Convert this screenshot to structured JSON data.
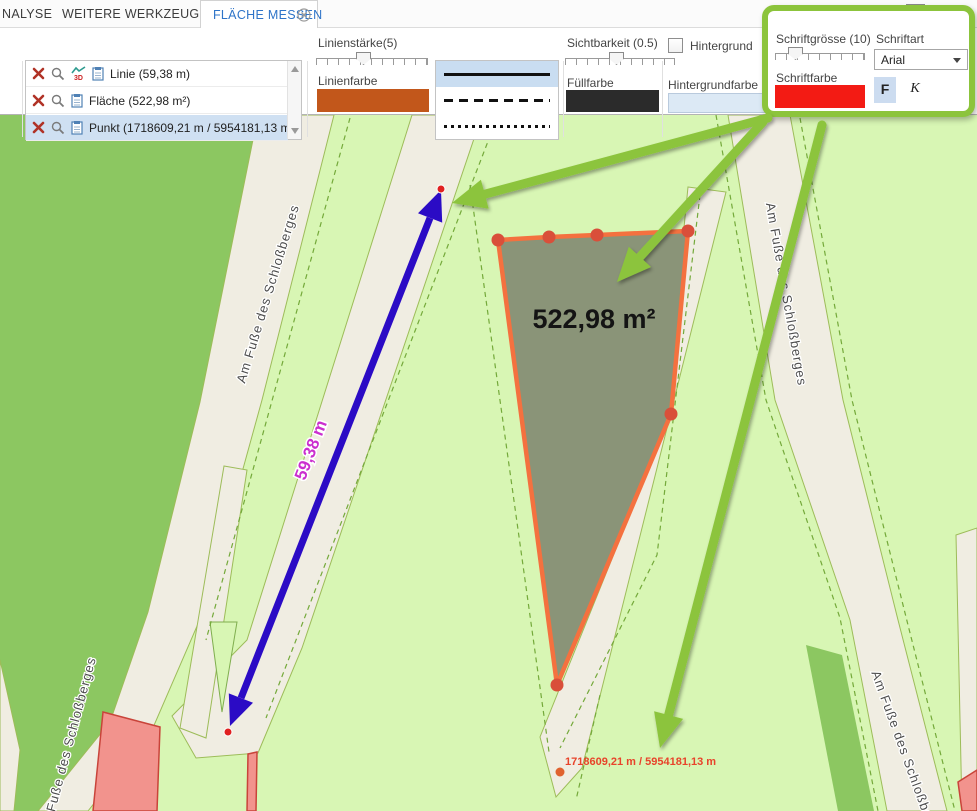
{
  "tabs": {
    "analyse": "NALYSE",
    "weitere": "WEITERE WERKZEUGE",
    "flaeche": "FLÄCHE MESSEN"
  },
  "header_right": {
    "info_glyph": "i",
    "label": "Sichtb"
  },
  "list": {
    "rows": [
      {
        "label": "Linie (59,38 m)"
      },
      {
        "label": "Fläche (522,98 m²)"
      },
      {
        "label": "Punkt (1718609,21 m / 5954181,13 m)"
      }
    ]
  },
  "panels": {
    "line": {
      "thickness_label": "Linienstärke(5)",
      "color_label": "Linienfarbe",
      "color": "#c2571b"
    },
    "visibility": {
      "label": "Sichtbarkeit (0.5)",
      "fill_label": "Füllfarbe",
      "fill_color": "#2b2b2b"
    },
    "background": {
      "checkbox_label": "Hintergrund",
      "color_label": "Hintergrundfarbe",
      "color": "#dce9f5"
    },
    "font": {
      "size_label": "Schriftgrösse (10)",
      "font_label": "Schriftart",
      "font_value": "Arial",
      "color_label": "Schriftfarbe",
      "color": "#f31b14",
      "bold": "F",
      "italic": "K"
    }
  },
  "map": {
    "street_name": "Am Fuße des Schloßberges",
    "area_label": "522,98 m²",
    "line_label": "59,38 m",
    "point_label": "1718609,21 m / 5954181,13 m"
  },
  "colors": {
    "highlight_green": "#8cc43c",
    "map_light_green": "#d8f6b4",
    "map_dark_green": "#8cc761",
    "street_cream": "#f0ede2",
    "area_fill": "#8a9478",
    "area_stroke": "#f4713f",
    "vertex_dot": "#d94f3a",
    "measure_blue": "#2b0bc5",
    "measure_magenta": "#cb2fcf",
    "point_orange": "#e8432a",
    "selected_row": "#cfe0f2",
    "active_tab_blue": "#2e74c8"
  }
}
